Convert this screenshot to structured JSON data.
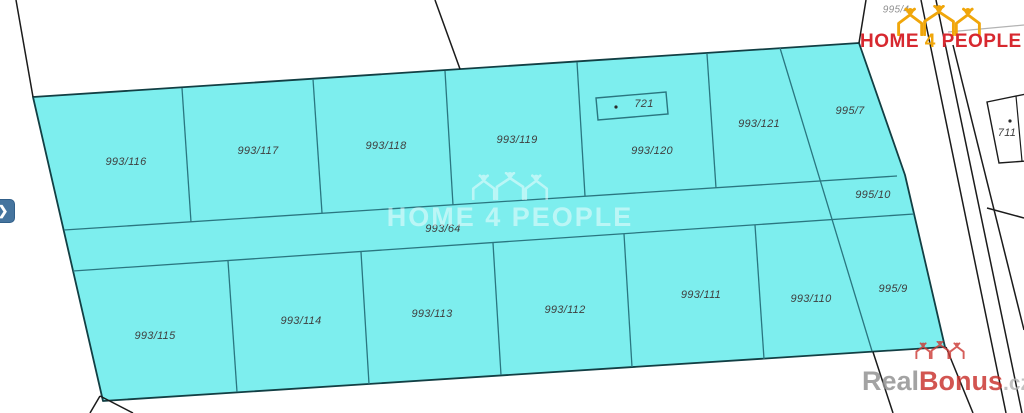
{
  "logo": {
    "home": "HOME",
    "four": "4",
    "people": "PEOPLE",
    "red": "#d7282f",
    "gold": "#f0a60a",
    "icon": "three-houses-with-people-icon"
  },
  "watermark_center": {
    "text": "HOME 4 PEOPLE",
    "icon_color": "#ffffff"
  },
  "watermark_corner": {
    "real": "Real",
    "bonus": "Bonus",
    "suffix": ".cz",
    "icon_color": "#cc3b36"
  },
  "controls": {
    "next_glyph": "❯"
  },
  "map_data": {
    "type": "cadastral-parcel-map",
    "colors": {
      "region_fill": "#7deeee",
      "region_outline": "#123f44",
      "inner_line": "#2a7680",
      "boundary_line": "#1b1b1b",
      "gray_line": "#b3b3b3",
      "label": "#3f3f3f",
      "label_gray": "#8f8f8f"
    },
    "region_outline": [
      [
        33,
        97
      ],
      [
        859,
        43
      ],
      [
        905,
        175
      ],
      [
        945,
        347
      ],
      [
        103,
        401
      ]
    ],
    "inner_lines": [
      [
        [
          64,
          230
        ],
        [
          897,
          176
        ]
      ],
      [
        [
          73,
          271
        ],
        [
          914,
          214
        ]
      ],
      [
        [
          182,
          88
        ],
        [
          191,
          222
        ]
      ],
      [
        [
          313,
          79
        ],
        [
          322,
          213
        ]
      ],
      [
        [
          445,
          71
        ],
        [
          453,
          205
        ]
      ],
      [
        [
          577,
          62
        ],
        [
          585,
          196
        ]
      ],
      [
        [
          707,
          54
        ],
        [
          716,
          188
        ]
      ],
      [
        [
          780,
          48
        ],
        [
          872,
          351
        ]
      ],
      [
        [
          228,
          261
        ],
        [
          237,
          392
        ]
      ],
      [
        [
          361,
          252
        ],
        [
          369,
          384
        ]
      ],
      [
        [
          493,
          243
        ],
        [
          501,
          375
        ]
      ],
      [
        [
          624,
          234
        ],
        [
          632,
          367
        ]
      ],
      [
        [
          755,
          225
        ],
        [
          764,
          359
        ]
      ]
    ],
    "outer_lines": [
      [
        [
          16,
          0
        ],
        [
          33,
          97
        ]
      ],
      [
        [
          435,
          0
        ],
        [
          460,
          69
        ]
      ],
      [
        [
          866,
          0
        ],
        [
          859,
          43
        ]
      ],
      [
        [
          921,
          0
        ],
        [
          1006,
          413
        ]
      ],
      [
        [
          936,
          0
        ],
        [
          1022,
          413
        ]
      ],
      [
        [
          953,
          45
        ],
        [
          1024,
          330
        ]
      ],
      [
        [
          873,
          352
        ],
        [
          893,
          413
        ]
      ],
      [
        [
          946,
          347
        ],
        [
          973,
          413
        ]
      ],
      [
        [
          987,
          208
        ],
        [
          1024,
          218
        ]
      ],
      [
        [
          100,
          396
        ],
        [
          90,
          413
        ]
      ],
      [
        [
          100,
          396
        ],
        [
          133,
          413
        ]
      ]
    ],
    "gray_lines": [
      [
        [
          948,
          32
        ],
        [
          1024,
          25
        ]
      ]
    ],
    "building_721": {
      "label": "721",
      "poly": [
        [
          596,
          98
        ],
        [
          666,
          92
        ],
        [
          668,
          114
        ],
        [
          598,
          120
        ]
      ],
      "dot": [
        616,
        107
      ]
    },
    "parcel_711": {
      "label": "711",
      "poly": [
        [
          987,
          102
        ],
        [
          1026,
          94
        ],
        [
          1026,
          161
        ],
        [
          999,
          163
        ]
      ],
      "inner_line": [
        [
          1016,
          96
        ],
        [
          1022,
          161
        ]
      ],
      "dot": [
        1010,
        121
      ]
    },
    "labels": [
      {
        "t": "993/116",
        "x": 126,
        "y": 162
      },
      {
        "t": "993/117",
        "x": 258,
        "y": 151
      },
      {
        "t": "993/118",
        "x": 386,
        "y": 146
      },
      {
        "t": "993/119",
        "x": 517,
        "y": 140
      },
      {
        "t": "993/120",
        "x": 652,
        "y": 151
      },
      {
        "t": "993/121",
        "x": 759,
        "y": 124
      },
      {
        "t": "995/7",
        "x": 850,
        "y": 111
      },
      {
        "t": "993/64",
        "x": 443,
        "y": 229
      },
      {
        "t": "995/10",
        "x": 873,
        "y": 195
      },
      {
        "t": "993/115",
        "x": 155,
        "y": 336
      },
      {
        "t": "993/114",
        "x": 301,
        "y": 321
      },
      {
        "t": "993/113",
        "x": 432,
        "y": 314
      },
      {
        "t": "993/112",
        "x": 565,
        "y": 310
      },
      {
        "t": "993/111",
        "x": 701,
        "y": 295
      },
      {
        "t": "993/110",
        "x": 811,
        "y": 299
      },
      {
        "t": "995/9",
        "x": 893,
        "y": 289
      },
      {
        "t": "721",
        "x": 644,
        "y": 104
      },
      {
        "t": "711",
        "x": 1007,
        "y": 133
      },
      {
        "t": "995/4",
        "x": 896,
        "y": 10,
        "gray": true
      }
    ]
  }
}
